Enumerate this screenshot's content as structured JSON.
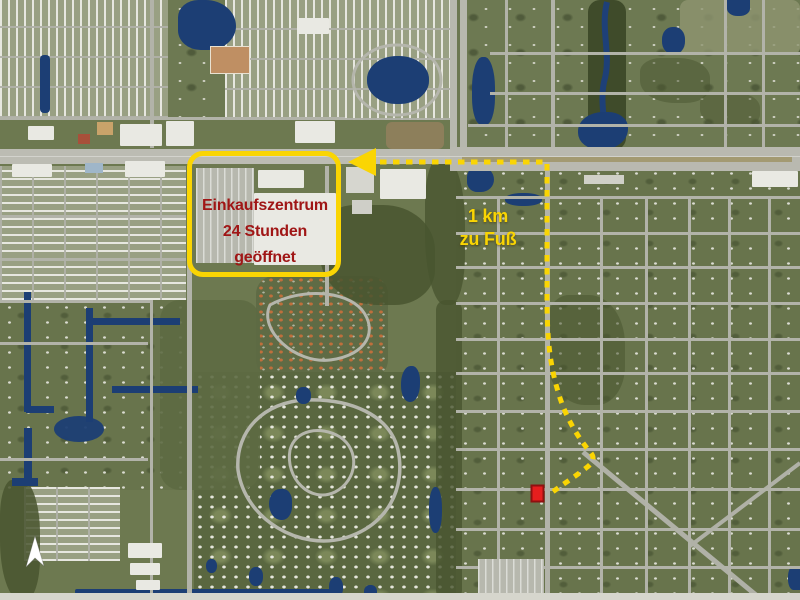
{
  "map": {
    "kind": "annotated satellite map",
    "palette": {
      "vegetation": "#6D7950",
      "water": "#1C3E74",
      "road": "#B2B3A9",
      "highway_median": "#A39A72"
    }
  },
  "annotations": {
    "shopping_center": {
      "lines": [
        "Einkaufszentrum",
        "24 Stunden",
        "geöffnet"
      ],
      "box_color": "#FAD503",
      "text_color": "#A01616"
    },
    "route": {
      "lines": [
        "1 km",
        "zu Fuß"
      ],
      "color": "#FAD503",
      "style": "dotted",
      "arrow_color": "#FAD503"
    },
    "destination_marker": {
      "fill": "#E61E1E",
      "border": "#8F1010"
    },
    "north_arrow": {
      "fill": "#FFFFFF"
    }
  },
  "icons": {
    "route_arrow": "left-arrowhead",
    "north_arrow": "north-compass-triangle",
    "destination": "red-rectangle-marker"
  }
}
